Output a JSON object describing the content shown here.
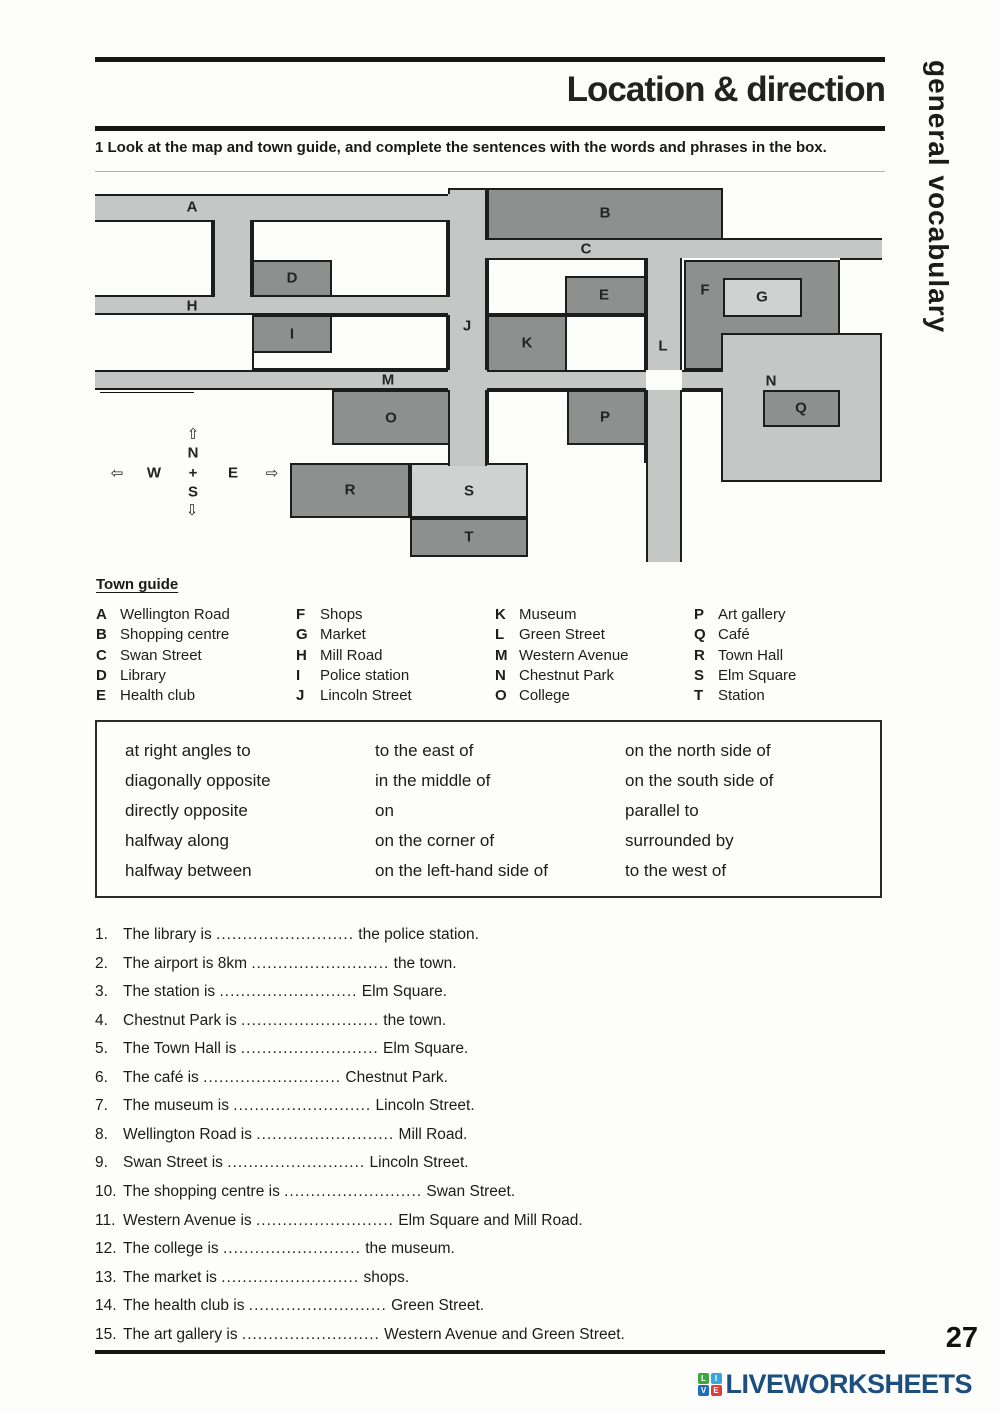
{
  "header": {
    "title": "Location & direction",
    "instruction": "1 Look at the map and town guide, and complete the sentences with the words and phrases in the box.",
    "sidebar_text": "general vocabulary"
  },
  "map": {
    "airport_sign": {
      "arrow": "⇦",
      "label": "Airport (8km)"
    },
    "compass": {
      "up_arrow": "⇧",
      "down_arrow": "⇩",
      "left_arrow": "⇦",
      "right_arrow": "⇨",
      "north": "N",
      "south": "S",
      "east": "E",
      "west": "W",
      "center": "+"
    },
    "street_labels": [
      "A",
      "C",
      "H",
      "J",
      "L",
      "M",
      "N",
      "S"
    ],
    "block_labels": [
      "B",
      "D",
      "E",
      "F",
      "G",
      "I",
      "K",
      "O",
      "P",
      "Q",
      "R",
      "T"
    ]
  },
  "town_guide": {
    "heading": "Town guide",
    "entries": [
      {
        "key": "A",
        "name": "Wellington Road"
      },
      {
        "key": "B",
        "name": "Shopping centre"
      },
      {
        "key": "C",
        "name": "Swan Street"
      },
      {
        "key": "D",
        "name": "Library"
      },
      {
        "key": "E",
        "name": "Health club"
      },
      {
        "key": "F",
        "name": "Shops"
      },
      {
        "key": "G",
        "name": "Market"
      },
      {
        "key": "H",
        "name": "Mill Road"
      },
      {
        "key": "I",
        "name": "Police station"
      },
      {
        "key": "J",
        "name": "Lincoln Street"
      },
      {
        "key": "K",
        "name": "Museum"
      },
      {
        "key": "L",
        "name": "Green Street"
      },
      {
        "key": "M",
        "name": "Western Avenue"
      },
      {
        "key": "N",
        "name": "Chestnut Park"
      },
      {
        "key": "O",
        "name": "College"
      },
      {
        "key": "P",
        "name": "Art gallery"
      },
      {
        "key": "Q",
        "name": "Café"
      },
      {
        "key": "R",
        "name": "Town Hall"
      },
      {
        "key": "S",
        "name": "Elm Square"
      },
      {
        "key": "T",
        "name": "Station"
      }
    ]
  },
  "phrase_box": {
    "columns": [
      [
        "at right angles to",
        "diagonally opposite",
        "directly opposite",
        "halfway along",
        "halfway between"
      ],
      [
        "to the east of",
        "in the middle of",
        "on",
        "on the corner of",
        "on the left-hand side of"
      ],
      [
        "on the north side of",
        "on the south side of",
        "parallel to",
        "surrounded by",
        "to the west of"
      ]
    ]
  },
  "exercise": {
    "blank": "..........................",
    "sentences": [
      {
        "num": "1.",
        "before": "The library is",
        "after": "the police station."
      },
      {
        "num": "2.",
        "before": "The airport is 8km",
        "after": "the town."
      },
      {
        "num": "3.",
        "before": "The station is",
        "after": "Elm Square."
      },
      {
        "num": "4.",
        "before": "Chestnut Park is",
        "after": "the town."
      },
      {
        "num": "5.",
        "before": "The Town Hall is",
        "after": "Elm Square."
      },
      {
        "num": "6.",
        "before": "The café is",
        "after": "Chestnut Park."
      },
      {
        "num": "7.",
        "before": "The museum is",
        "after": "Lincoln Street."
      },
      {
        "num": "8.",
        "before": "Wellington Road is",
        "after": "Mill Road."
      },
      {
        "num": "9.",
        "before": "Swan Street is",
        "after": "Lincoln Street."
      },
      {
        "num": "10.",
        "before": "The shopping centre is",
        "after": "Swan Street."
      },
      {
        "num": "11.",
        "before": "Western Avenue is",
        "after": "Elm Square and Mill Road."
      },
      {
        "num": "12.",
        "before": "The college is",
        "after": "the museum."
      },
      {
        "num": "13.",
        "before": "The market is",
        "after": "shops."
      },
      {
        "num": "14.",
        "before": "The health club is",
        "after": "Green Street."
      },
      {
        "num": "15.",
        "before": "The art gallery is",
        "after": "Western Avenue and Green Street."
      }
    ]
  },
  "footer": {
    "page_number": "27",
    "logo_text": "LIVEWORKSHEETS",
    "logo_squares": [
      {
        "letter": "L",
        "color": "#3fa63f"
      },
      {
        "letter": "I",
        "color": "#35a8e0"
      },
      {
        "letter": "V",
        "color": "#1d6fb8"
      },
      {
        "letter": "E",
        "color": "#e23b3b"
      }
    ]
  }
}
